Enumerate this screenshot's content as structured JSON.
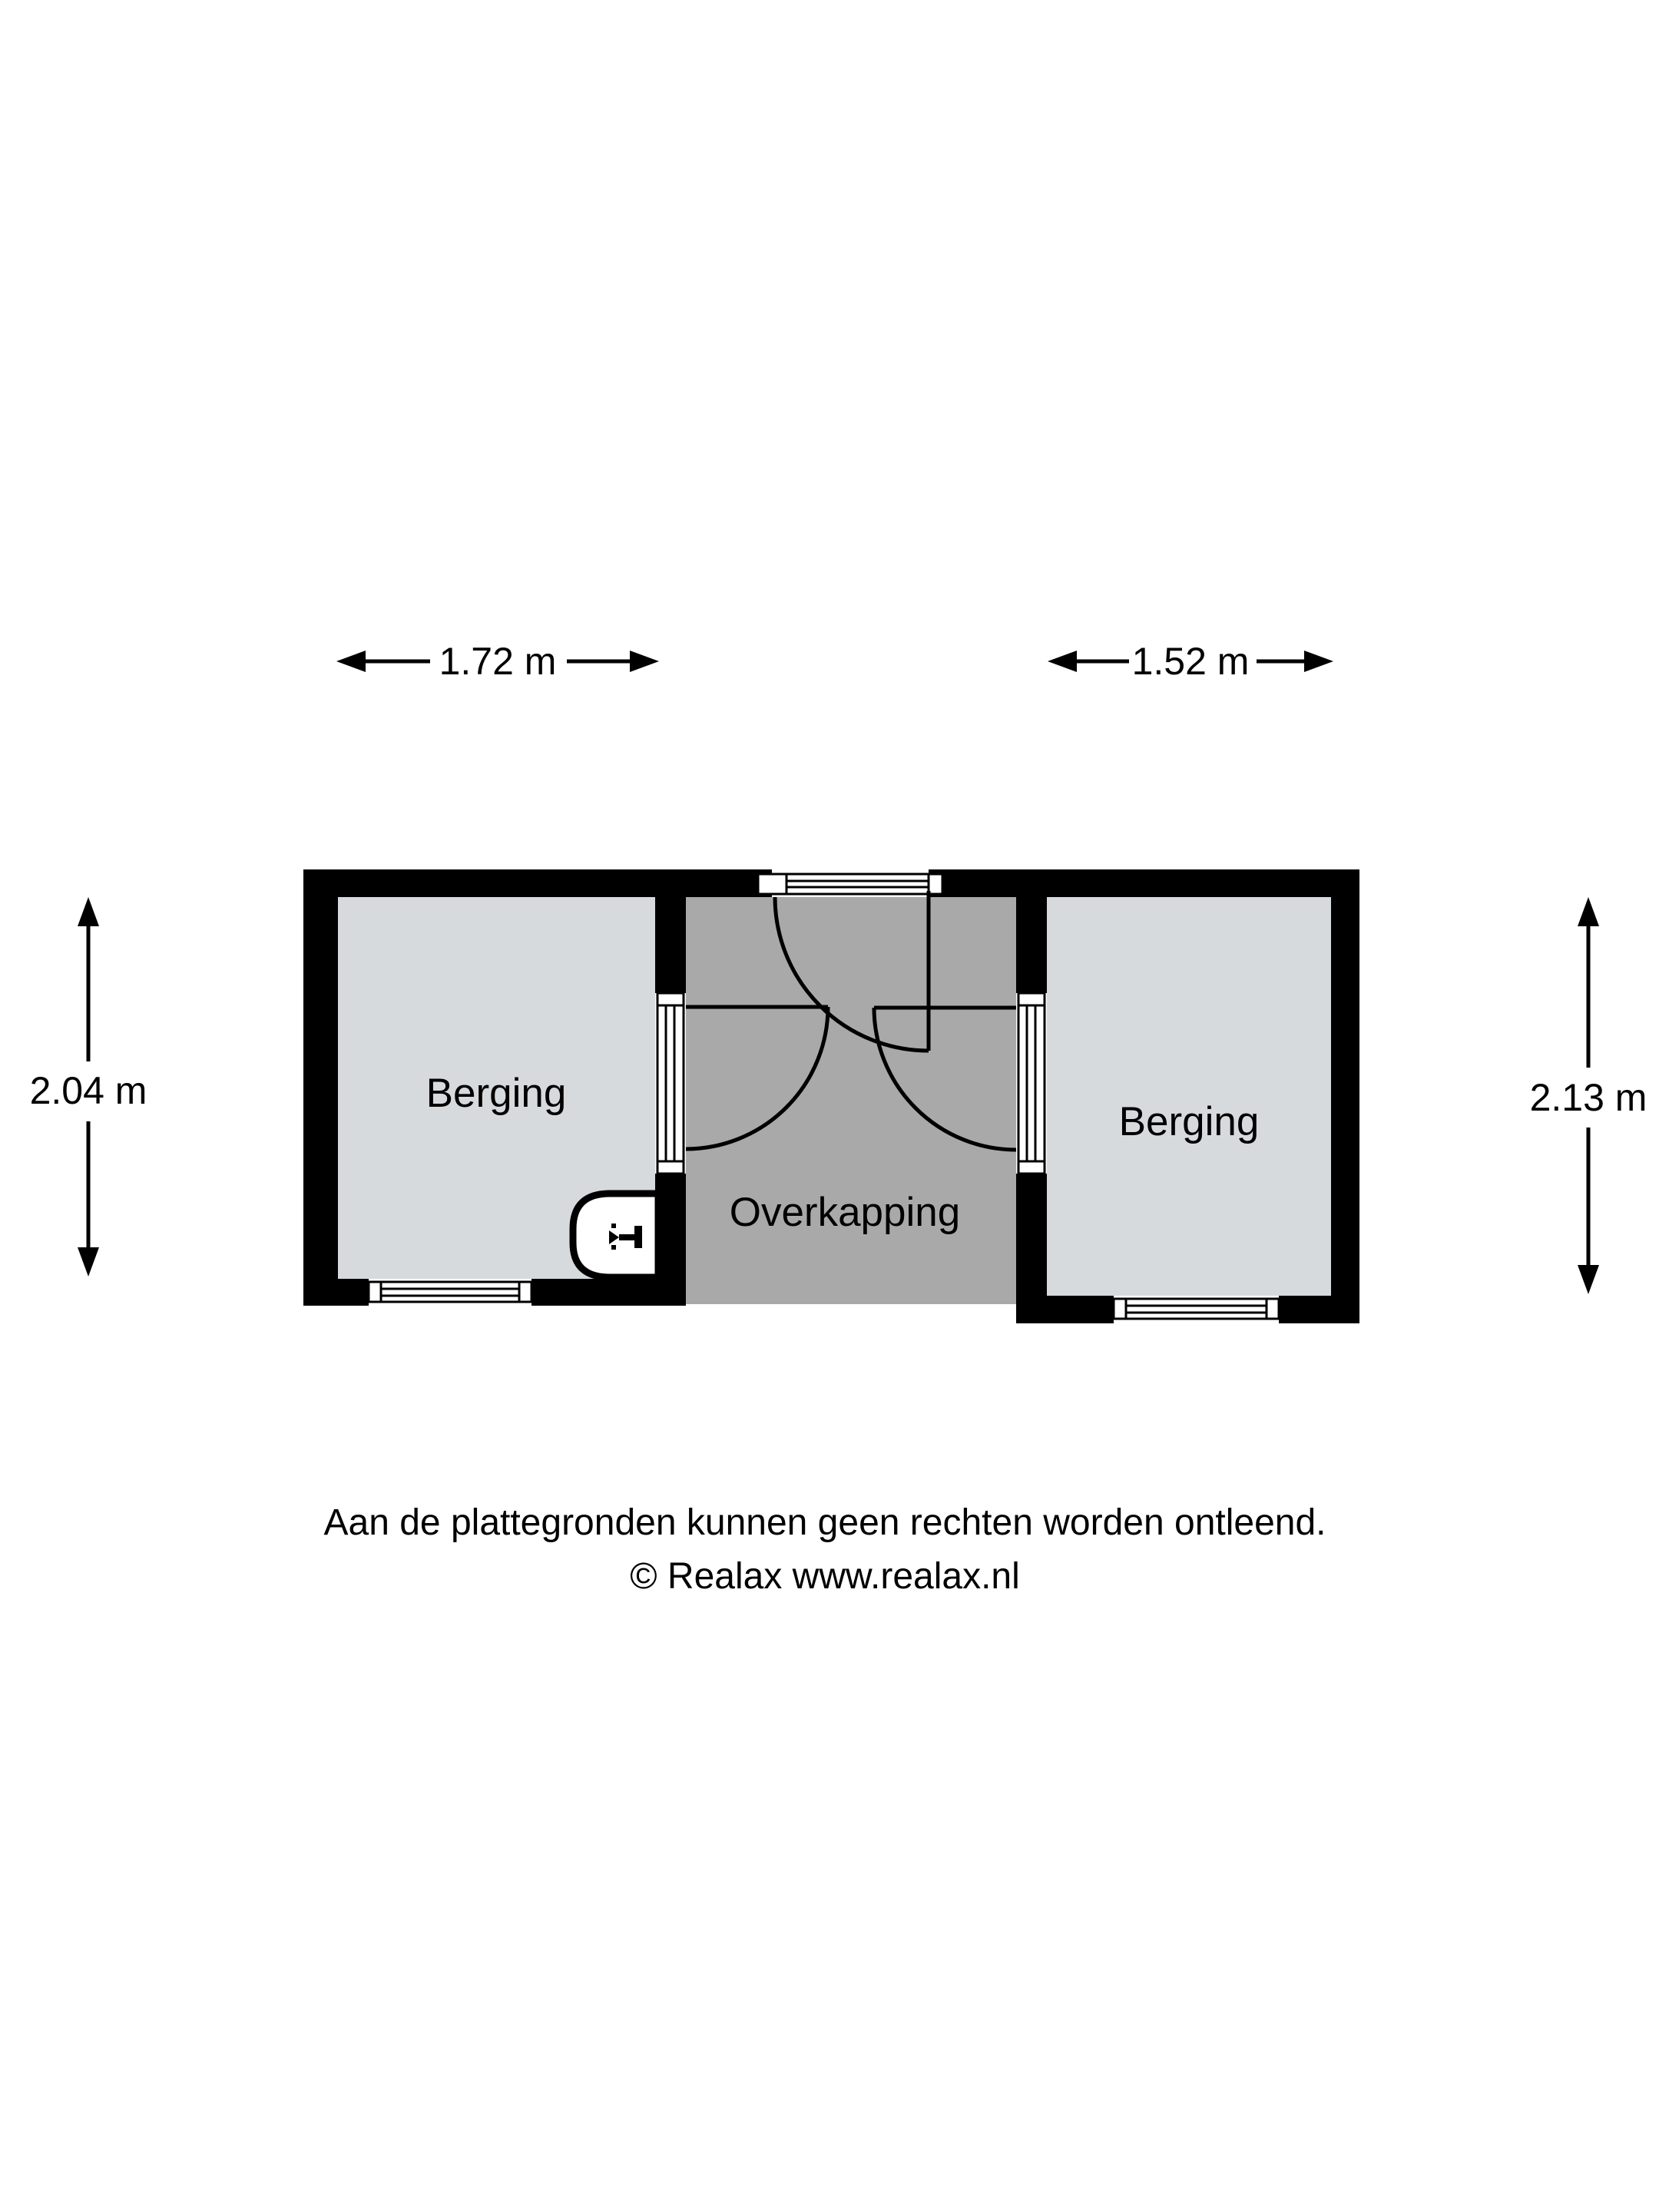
{
  "rooms": {
    "left": {
      "label": "Berging"
    },
    "middle": {
      "label": "Overkapping"
    },
    "right": {
      "label": "Berging"
    }
  },
  "dimensions": {
    "top_left": "1.72 m",
    "top_right": "1.52 m",
    "left": "2.04 m",
    "right": "2.13 m"
  },
  "footer": {
    "disclaimer": "Aan de plattegronden kunnen geen rechten worden ontleend.",
    "copyright": "© Realax www.realax.nl"
  },
  "icons": {
    "fixture": "water-tap-icon"
  },
  "colors": {
    "wall": "#000000",
    "room_fill": "#d7dadd",
    "canopy_fill": "#a9a9a9",
    "line": "#000000",
    "background": "#ffffff"
  }
}
